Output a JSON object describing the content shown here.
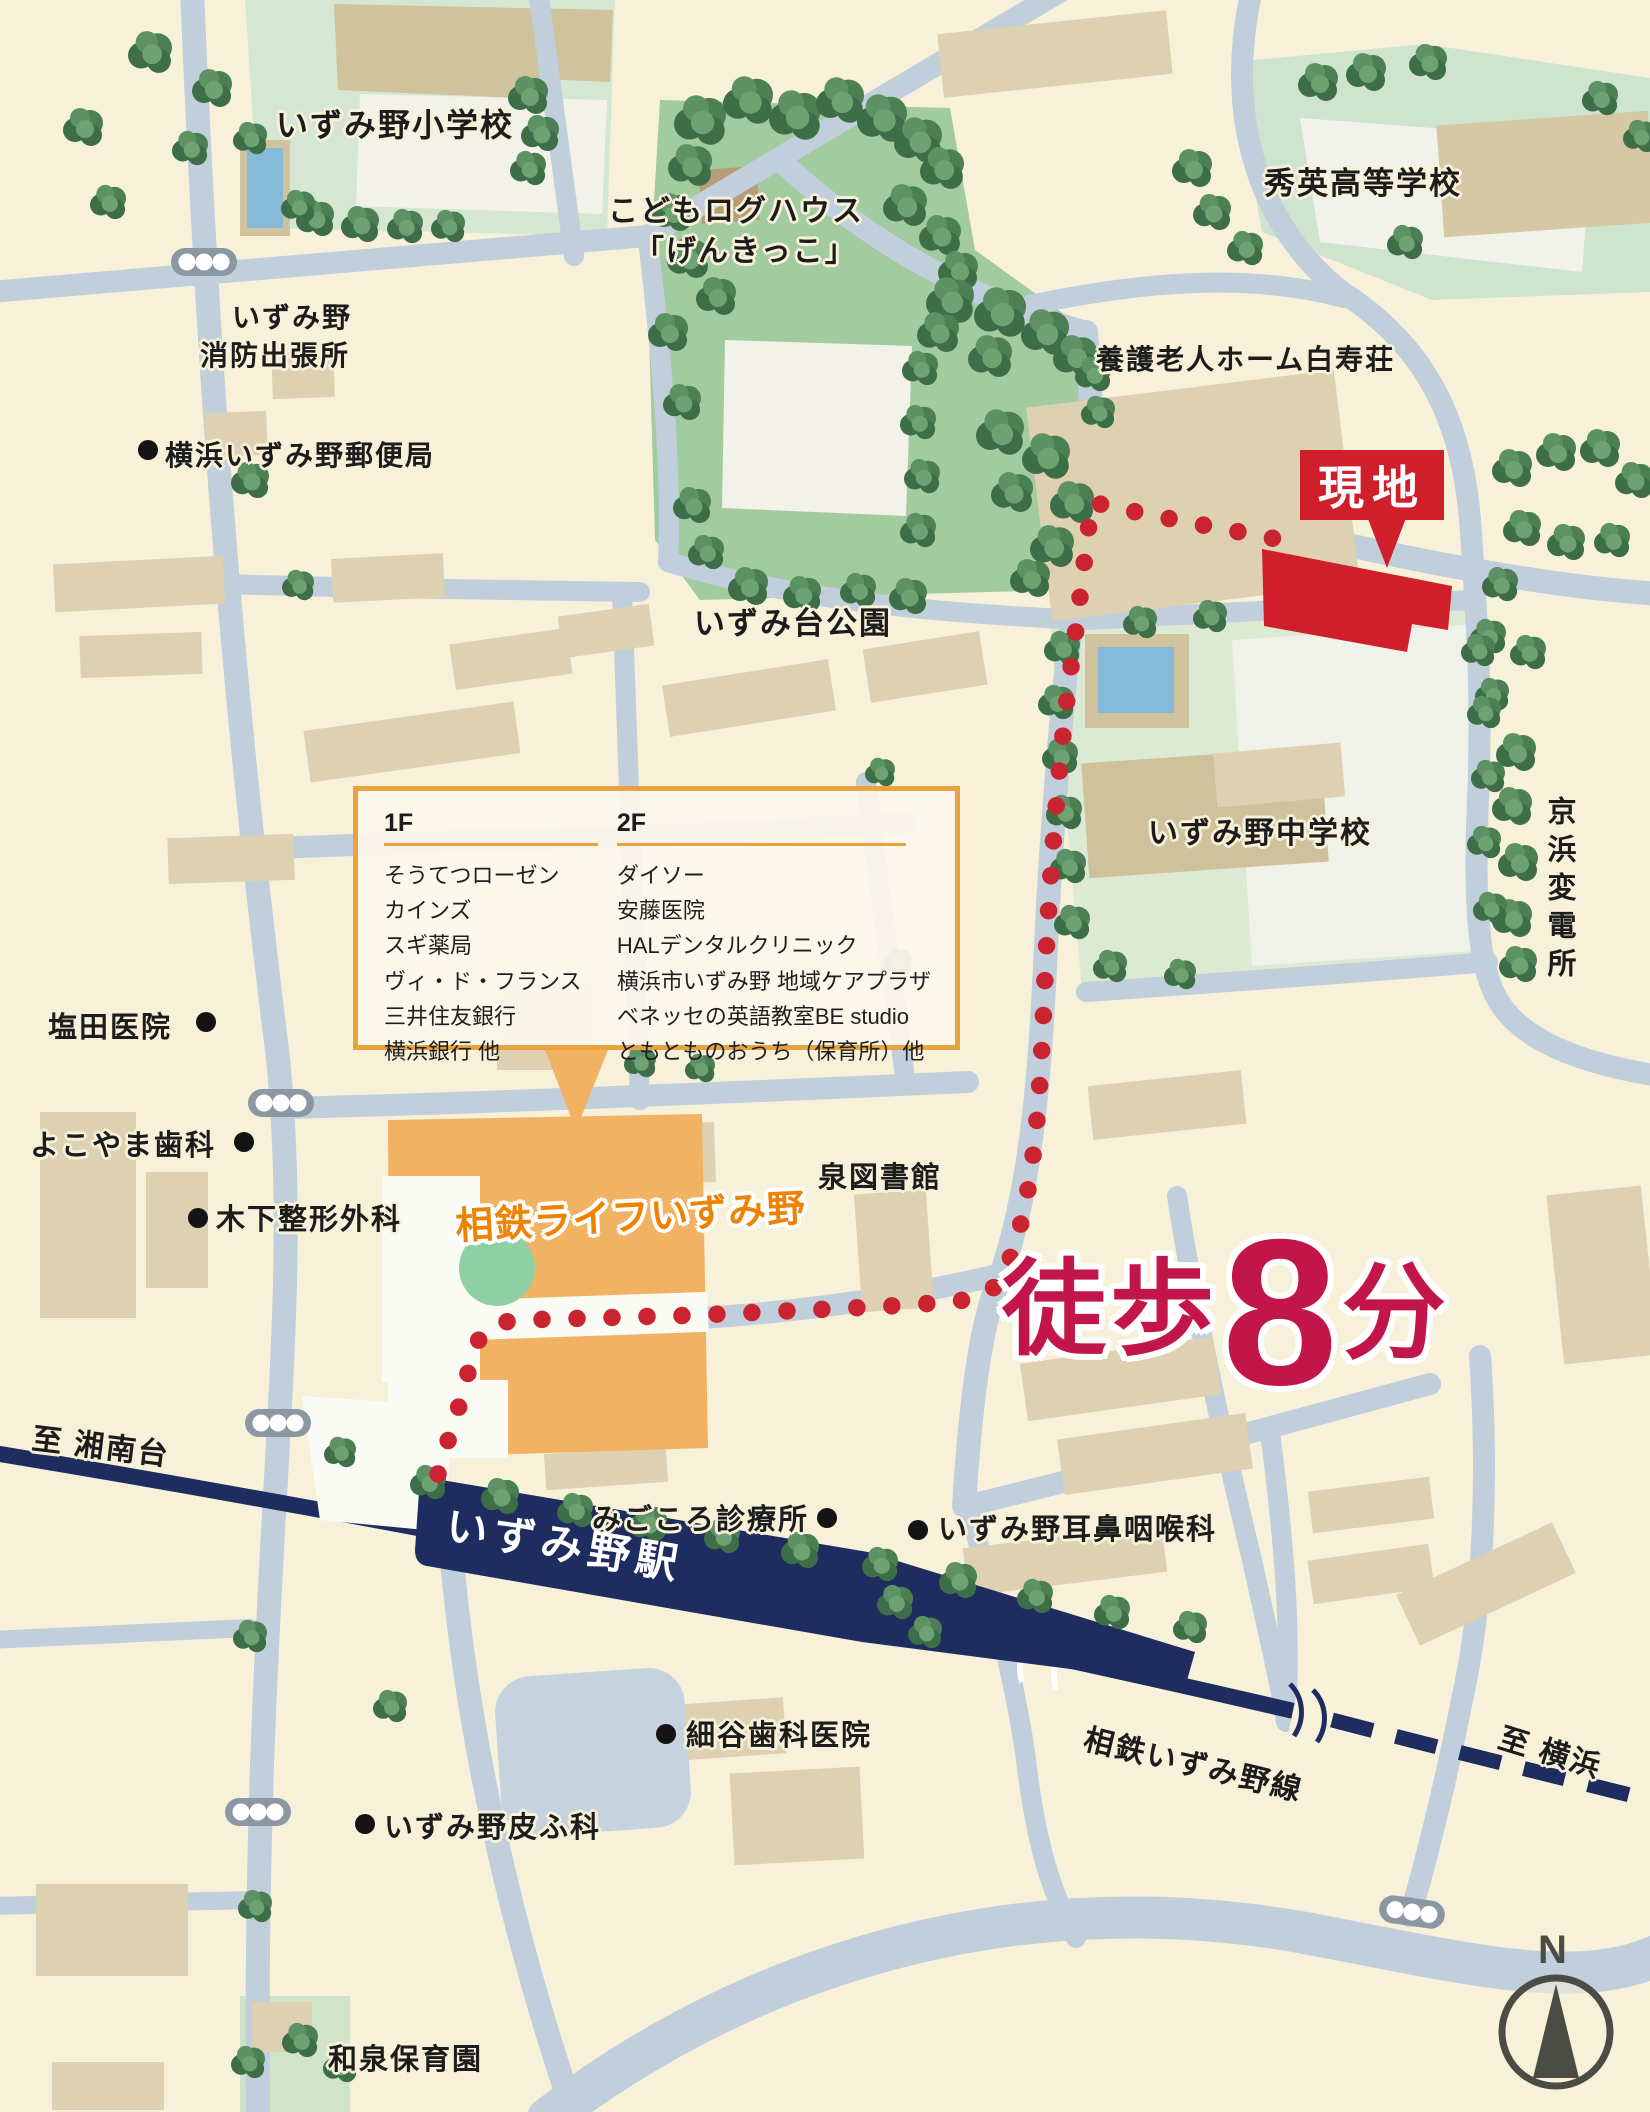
{
  "places": {
    "elementary_school": "いずみ野小学校",
    "log_house_line1": "こどもログハウス",
    "log_house_line2": "「げんきっこ」",
    "high_school": "秀英高等学校",
    "fire_station_line1": "いずみ野",
    "fire_station_line2": "消防出張所",
    "post_office": "横浜いずみ野郵便局",
    "park": "いずみ台公園",
    "nursing_home": "養護老人ホーム白寿荘",
    "site": "現地",
    "junior_high_school": "いずみ野中学校",
    "substation": "京浜変電所",
    "shioda_clinic": "塩田医院",
    "yokoyama_dental": "よこやま歯科",
    "kinoshita_orthopedics": "木下整形外科",
    "sotetsu_life": "相鉄ライフいずみ野",
    "izumi_library": "泉図書館",
    "to_shonandai": "至 湘南台",
    "station": "いずみ野駅",
    "migokoro_clinic": "みごころ診療所",
    "ent_clinic": "いずみ野耳鼻咽喉科",
    "hosoya_dental": "細谷歯科医院",
    "dermatology_clinic": "いずみ野皮ふ科",
    "rail_line": "相鉄いずみ野線",
    "to_yokohama": "至 横浜",
    "nursery": "和泉保育園"
  },
  "tenant_box": {
    "floor1_header": "1F",
    "floor2_header": "2F",
    "floor1_items": [
      "そうてつローゼン",
      "カインズ",
      "スギ薬局",
      "ヴィ・ド・フランス",
      "三井住友銀行",
      "横浜銀行 他"
    ],
    "floor2_items": [
      "ダイソー",
      "安藤医院",
      "HALデンタルクリニック",
      "横浜市いずみ野 地域ケアプラザ",
      "ベネッセの英語教室BE studio",
      "ともとものおうち（保育所）他"
    ]
  },
  "walk_time": {
    "prefix": "徒歩",
    "number": "8",
    "unit": "分"
  },
  "compass": {
    "north": "N"
  },
  "colors": {
    "background": "#f8f1da",
    "road": "#c1cedb",
    "park_green": "#a3cba0",
    "ground_green": "#dcead4",
    "building_beige": "#ded1b2",
    "rail_navy": "#1e2c60",
    "site_red": "#ce1f2a",
    "route_red": "#c92430",
    "walk_crimson": "#c2164a",
    "shopping_orange": "#f1b264",
    "orange_accent": "#e8a340",
    "sotetsu_text_orange": "#ef8200"
  }
}
